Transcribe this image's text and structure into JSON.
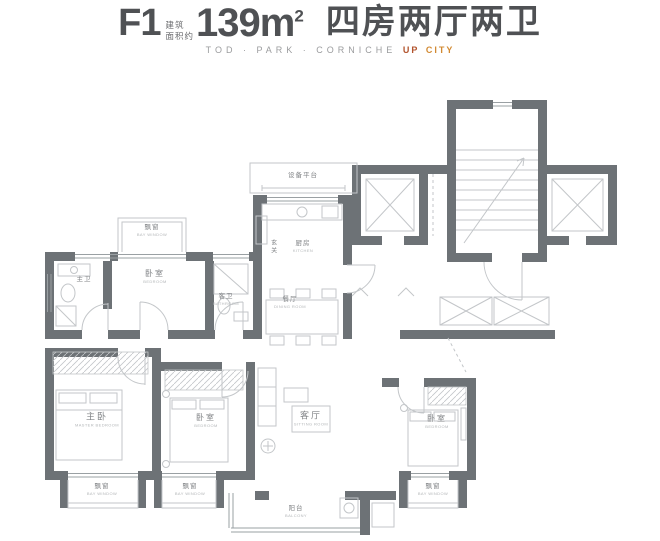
{
  "header": {
    "model": "F1",
    "area_note_line1": "建筑",
    "area_note_line2": "面积约",
    "area_value": "139m",
    "area_sup": "2",
    "layout_text": "四房两厅两卫",
    "tagline": "TOD · PARK · CORNICHE",
    "tagline_accent_1": "UP",
    "tagline_accent_2": "CITY"
  },
  "colors": {
    "wall-color": "#6d7276",
    "window-color": "#9aa0a3",
    "furn-color": "#c3c6c9",
    "label-color": "#808386",
    "sublabel-color": "#b3b6b8",
    "title-color": "#4f5154",
    "subtitle-color": "#9b9c9e",
    "accent-up": "#b2532c",
    "accent-city": "#d28a33"
  },
  "rooms": [
    {
      "name": "设备平台",
      "sub": ""
    },
    {
      "name": "厨房",
      "sub": "KITCHEN"
    },
    {
      "name": "玄关",
      "sub": ""
    },
    {
      "name": "餐厅",
      "sub": "DINING ROOM"
    },
    {
      "name": "主卫",
      "sub": ""
    },
    {
      "name": "卧室",
      "sub": "BEDROOM"
    },
    {
      "name": "客卫",
      "sub": "BATHROOM"
    },
    {
      "name": "飘窗",
      "sub": "BAY WINDOW"
    },
    {
      "name": "主卧",
      "sub": "MASTER BEDROOM"
    },
    {
      "name": "卧室",
      "sub": "BEDROOM"
    },
    {
      "name": "客厅",
      "sub": "SITTING ROOM"
    },
    {
      "name": "卧室",
      "sub": "BEDROOM"
    },
    {
      "name": "阳台",
      "sub": "BALCONY"
    },
    {
      "name": "飘窗",
      "sub": "BAY WINDOW"
    },
    {
      "name": "飘窗",
      "sub": "BAY WINDOW"
    },
    {
      "name": "飘窗",
      "sub": "BAY WINDOW"
    }
  ]
}
